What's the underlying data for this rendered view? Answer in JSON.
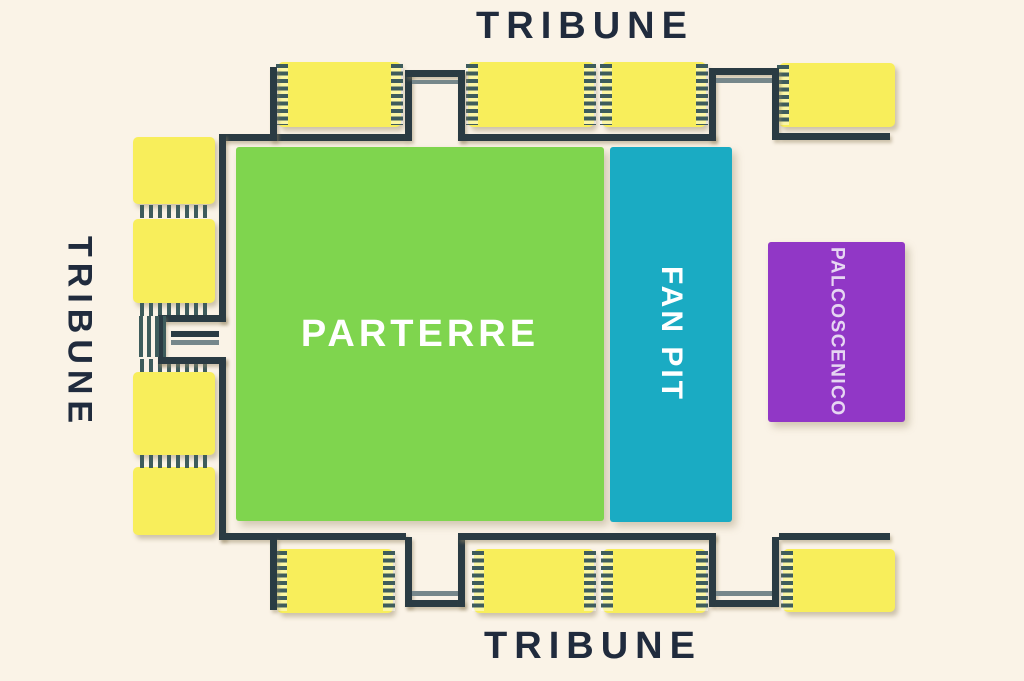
{
  "labels": {
    "tribune_top": "TRIBUNE",
    "tribune_left": "TRIBUNE",
    "tribune_bottom": "TRIBUNE",
    "parterre": "PARTERRE",
    "fan_pit": "FAN PIT",
    "stage": "PALCOSCENICO"
  },
  "colors": {
    "background": "#faf3e7",
    "tribune-yellow": "#f8ee5b",
    "parterre-green": "#7fd54e",
    "fanpit-teal": "#1aabc3",
    "stage-purple": "#9137c6",
    "stage-text": "#e6d6f2",
    "wall-dark": "#2a3b43",
    "hatch-dark": "#3e5c5c",
    "text-navy": "#202b3d",
    "line-gray": "#76878b"
  }
}
